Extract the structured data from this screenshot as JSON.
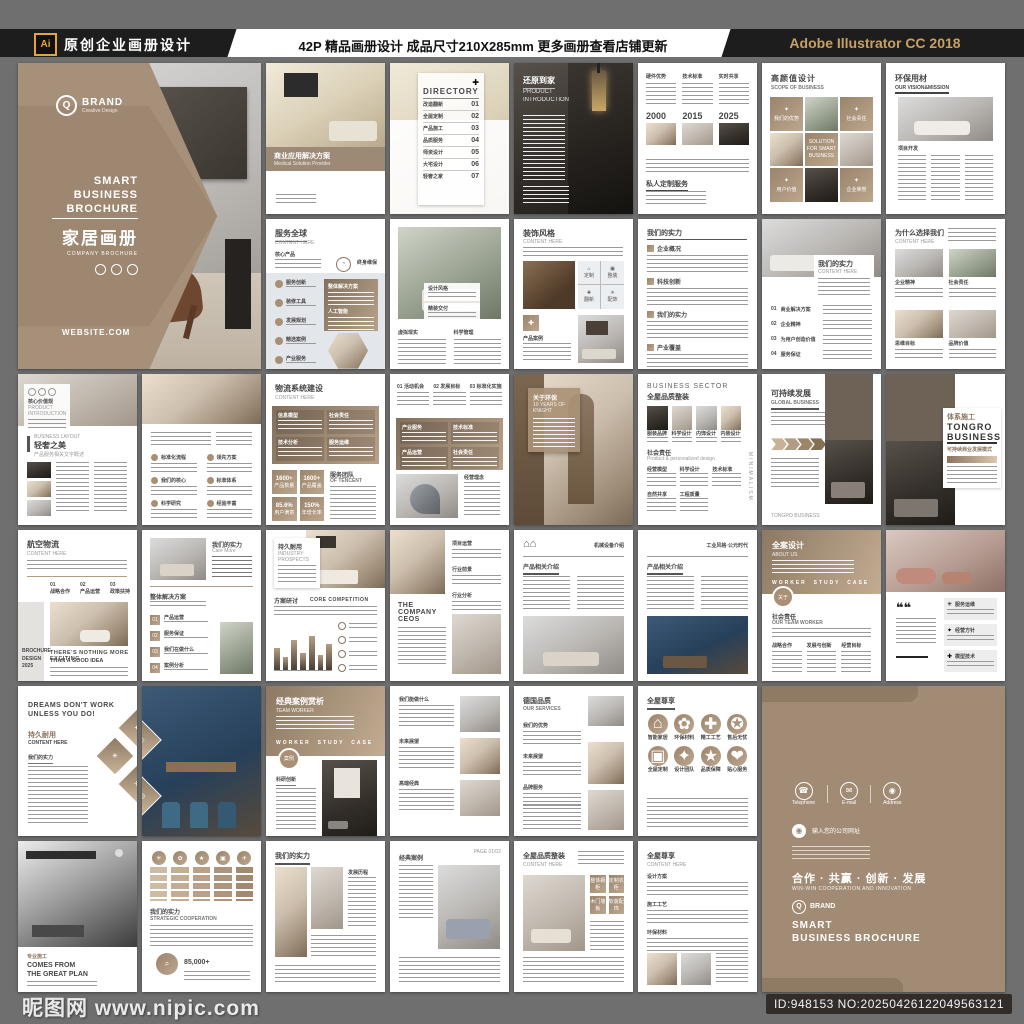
{
  "header": {
    "logo": "Ai",
    "left_title": "原创企业画册设计",
    "center_text": "42P 精品画册设计 成品尺寸210X285mm 更多画册查看店铺更新",
    "right_text": "Adobe Illustrator CC 2018"
  },
  "watermark": {
    "site": "昵图网 www.nipic.com",
    "id_text": "ID:948153 NO:20250426122049563121"
  },
  "cover": {
    "brand": "BRAND",
    "brand_sub": "Creative Design",
    "brand_letter": "Q",
    "line1": "SMART",
    "line2": "BUSINESS",
    "line3": "BROCHURE",
    "title_cn": "家居画册",
    "subtitle": "COMPANY BROCHURE",
    "website": "WEBSITE.COM"
  },
  "back": {
    "contact1": "Telephone",
    "contact2": "E-mail",
    "contact3": "Address",
    "phone_icon": "☎",
    "mail_icon": "✉",
    "pin_icon": "◉",
    "address_bar": "输入您的公司网址",
    "slogan_cn": "合作 · 共赢 · 创新 · 发展",
    "slogan_en": "WIN-WIN COOPERATION AND INNOVATION",
    "brand": "BRAND",
    "brand_letter": "Q",
    "title1": "SMART",
    "title2": "BUSINESS BROCHURE"
  },
  "pages": {
    "p03": {
      "title_cn": "商业应用解决方案",
      "title_en": "Medical Solution Provider"
    },
    "p04": {
      "title": "DIRECTORY",
      "icon": "✚",
      "items": [
        {
          "num": "01",
          "label": "改造翻新"
        },
        {
          "num": "02",
          "label": "全屋定制"
        },
        {
          "num": "03",
          "label": "产品施工"
        },
        {
          "num": "04",
          "label": "品质服务"
        },
        {
          "num": "05",
          "label": "师资设计"
        },
        {
          "num": "06",
          "label": "大宅设计"
        },
        {
          "num": "07",
          "label": "轻奢之家"
        }
      ]
    },
    "p05": {
      "title_cn": "还原到家",
      "title_en1": "PRODUCT",
      "title_en2": "INTRODUCTION"
    },
    "p06": {
      "heads": [
        "硬件优势",
        "技术标准",
        "实时共享"
      ],
      "years": [
        "2000",
        "2015",
        "2025"
      ],
      "bottom": "私人定制服务"
    },
    "p07": {
      "title_cn": "高颜值设计",
      "title_en": "SCOPE OF BUSINESS",
      "center": "SOLUTION FOR SMART BUSINESS",
      "cells": [
        "我们的优势",
        "社会责任",
        "用户价值",
        "企业荣誉"
      ]
    },
    "p08": {
      "title_cn": "环保用材",
      "title_en": "OUR VISION&MISSION",
      "sub": "项目开发"
    },
    "p09": {
      "title_cn": "服务全球",
      "title_en": "CONTENT HERE",
      "lead": "核心产品",
      "items": [
        "服务创新",
        "装修工具",
        "发展规划",
        "精选案例",
        "产业服务"
      ],
      "panel1": "整体解决方案",
      "panel2": "人工智能",
      "side": "终身维保"
    },
    "p10": {
      "card1": "设计风格",
      "card2": "精装交付",
      "col1": "虚拟现实",
      "col2": "科学管理"
    },
    "p11": {
      "title_cn": "装饰风格",
      "title_en": "CONTENT HERE",
      "tag": "产品案例",
      "quad": [
        "定制",
        "整装",
        "翻新",
        "配饰"
      ]
    },
    "p12": {
      "title": "我们的实力",
      "sections": [
        "企业概况",
        "科技创新",
        "我们的实力",
        "产业覆盖"
      ]
    },
    "p13": {
      "title_cn": "我们的实力",
      "title_en": "CONTENT HERE",
      "items": [
        {
          "num": "01",
          "label": "商业解决方案"
        },
        {
          "num": "02",
          "label": "企业精神"
        },
        {
          "num": "03",
          "label": "为用户创造价值"
        },
        {
          "num": "04",
          "label": "服务保证"
        }
      ]
    },
    "p14": {
      "title_cn": "为什么选择我们",
      "title_en": "CONTENT HERE",
      "labels": [
        "企业精神",
        "社会责任",
        "思维目标",
        "品牌价值"
      ]
    },
    "p15": {
      "overlay_cn": "核心价值观",
      "overlay_en": "PRODUCT INTRODUCTION",
      "small": "BUSINESS LAYOUT",
      "title": "轻奢之美",
      "sub": "产品服务相关文字概述"
    },
    "p16": {
      "left": [
        "标准化流程",
        "我们的核心",
        "科学研究"
      ],
      "right": [
        "领先方案",
        "标准体系",
        "经验丰富"
      ]
    },
    "p17": {
      "title_cn": "物流系统建设",
      "title_en": "CONTENT HERE",
      "panel": [
        "信息模型",
        "社会责任",
        "技术分析",
        "服务运维"
      ],
      "stats": [
        {
          "v": "1600+",
          "l": "产品数量"
        },
        {
          "v": "1600+",
          "l": "产品覆盖"
        },
        {
          "v": "85.6%",
          "l": "用户满意"
        },
        {
          "v": "150%",
          "l": "年增长率"
        }
      ],
      "side_cn": "服务团队",
      "side_en": "OF TENCENT"
    },
    "p18": {
      "heads": [
        {
          "num": "01",
          "label": "活动机会"
        },
        {
          "num": "02",
          "label": "发展目标"
        },
        {
          "num": "03",
          "label": "标准化实施"
        }
      ],
      "panel": [
        "产业服务",
        "技术标准",
        "产品运营",
        "社会责任"
      ],
      "side": "经营理念"
    },
    "p19": {
      "overlay_cn": "关于环保",
      "overlay_en": "10 YEARS OF KNIGHT"
    },
    "p20": {
      "title_en": "BUSINESS SECTOR",
      "title_cn": "全屋品质整装",
      "thumbs": [
        "服装品牌",
        "科学设计",
        "内饰设计",
        "内装设计"
      ],
      "sub_cn": "社会责任",
      "sub_en": "Product & personalized design",
      "blocks": [
        "经营模型",
        "科学设计",
        "技术标准",
        "自然共享",
        "工程质量"
      ],
      "side_vertical": "MINIMALISM"
    },
    "p21": {
      "title_cn": "可持续发展",
      "title_en": "GLOBAL BUSINESS",
      "side": "TONGRO BUSINESS"
    },
    "p22": {
      "title_cn": "体系施工",
      "brand1": "TONGRO",
      "brand2": "BUSINESS",
      "sub": "可持续商业发展模式"
    },
    "p23": {
      "title_cn": "航空物流",
      "title_en": "CONTENT HERE",
      "steps": [
        {
          "num": "01",
          "label": "战略合作"
        },
        {
          "num": "02",
          "label": "产品运营"
        },
        {
          "num": "03",
          "label": "政策扶持"
        }
      ],
      "quote1": "THERE'S NOTHING MORE EXCITING",
      "quote2": "THAN A GOOD IDEA",
      "side1": "BROCHURE",
      "side2": "DESIGN",
      "side3": "2025"
    },
    "p24": {
      "head_cn": "我们的实力",
      "head_en": "Care More",
      "title": "整体解决方案",
      "items": [
        {
          "num": "01",
          "label": "产品运营"
        },
        {
          "num": "02",
          "label": "服务保证"
        },
        {
          "num": "03",
          "label": "我们在做什么"
        },
        {
          "num": "04",
          "label": "案例分析"
        }
      ]
    },
    "p25": {
      "overlay_cn": "持久耐用",
      "overlay_en1": "INDUSTRY",
      "overlay_en2": "PROSPECTS",
      "sec_cn": "方案研讨",
      "sec_en": "CORE COMPETITION",
      "bars": [
        45,
        28,
        62,
        36,
        70,
        32,
        55
      ]
    },
    "p26": {
      "heads": [
        "项目运营",
        "行业前景",
        "行业分析"
      ],
      "block1": "THE COMPANY",
      "block2": "CEOS"
    },
    "p27": {
      "top_right": "机械设备介绍",
      "title": "产品相关介绍",
      "icon": "⌂"
    },
    "p28": {
      "top_right": "工业风格·公元时代",
      "title": "产品相关介绍"
    },
    "p29": {
      "title_cn": "全案设计",
      "title_en": "ABOUT US",
      "tabs": [
        "WORKER",
        "STUDY",
        "CASE"
      ],
      "badge": "关于",
      "sec_cn": "社会责任",
      "sec_en": "OUR TEAM WORKER",
      "cols": [
        "战略合作",
        "发展与创新",
        "经营目标"
      ]
    },
    "p30": {
      "quote": "❝❝",
      "cards": [
        "服务运维",
        "经营方针",
        "模型技术"
      ]
    },
    "p31": {
      "slogan1": "DREAMS DON'T WORK",
      "slogan2": "UNLESS YOU DO!",
      "title_cn": "持久耐用",
      "title_en": "CONTENT HERE",
      "sec": "我们的实力"
    },
    "p33": {
      "title_cn": "经典案例赏析",
      "title_en": "TEAM WORKER",
      "tabs": [
        "WORKER",
        "STUDY",
        "CASE"
      ],
      "badge": "案例",
      "sec": "科研创新"
    },
    "p34": {
      "rows": [
        "我们能做什么",
        "未来展望",
        "高端经典"
      ]
    },
    "p35": {
      "title_cn": "德国品质",
      "title_en": "OUR SERVICES",
      "items": [
        "我们的优势",
        "未来展望",
        "品牌服务"
      ]
    },
    "p36": {
      "title": "全屋尊享",
      "circles": [
        "智能家居",
        "环保材料",
        "精工工艺",
        "售后无忧",
        "全屋定制",
        "设计团队",
        "品质保障",
        "贴心服务"
      ]
    },
    "p37": {
      "title_cn": "专业施工",
      "title_en1": "COMES FROM",
      "title_en2": "THE GREAT PLAN"
    },
    "p38": {
      "title_cn": "我们的实力",
      "title_en": "STRATEGIC COOPERATION",
      "stat": "85,000+"
    },
    "p39": {
      "title": "我们的实力",
      "sub": "发展历程"
    },
    "p40": {
      "page_no": "PAGE 01/02",
      "head": "经典案例"
    },
    "p41": {
      "title_cn": "全屋品质整装",
      "title_en": "CONTENT HERE",
      "tags": [
        "整体橱柜",
        "定制衣柜",
        "木门墙板",
        "软装配饰"
      ]
    },
    "p42": {
      "title_cn": "全屋尊享",
      "title_en": "CONTENT HERE",
      "items": [
        "设计方案",
        "施工工艺",
        "环保材料"
      ]
    }
  }
}
